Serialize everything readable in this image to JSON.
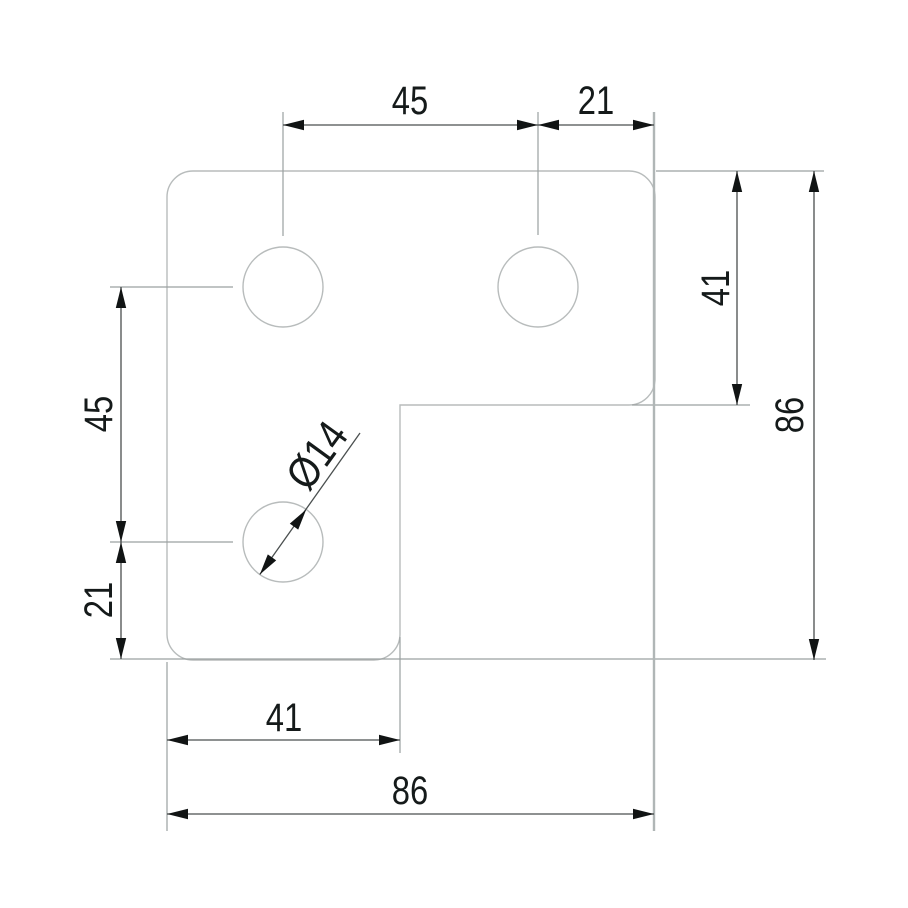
{
  "drawing": {
    "type": "technical-dimension-drawing",
    "part": "L-shaped corner plate with three holes"
  },
  "colors": {
    "background": "#ffffff",
    "outline": "#b8bcbc",
    "extension": "#9aa0a0",
    "extension_thick": "#b0b6b6",
    "dimension": "#4a4f4f",
    "arrow": "#111414",
    "text": "#151a1a"
  },
  "dimensions": {
    "top": {
      "hole_spacing": "45",
      "edge_offset": "21"
    },
    "right": {
      "arm_height": "41",
      "overall_height": "86"
    },
    "left": {
      "hole_spacing": "45",
      "edge_offset": "21"
    },
    "bottom": {
      "arm_width": "41",
      "overall_width": "86"
    },
    "hole": {
      "diameter": "Ø14"
    }
  }
}
